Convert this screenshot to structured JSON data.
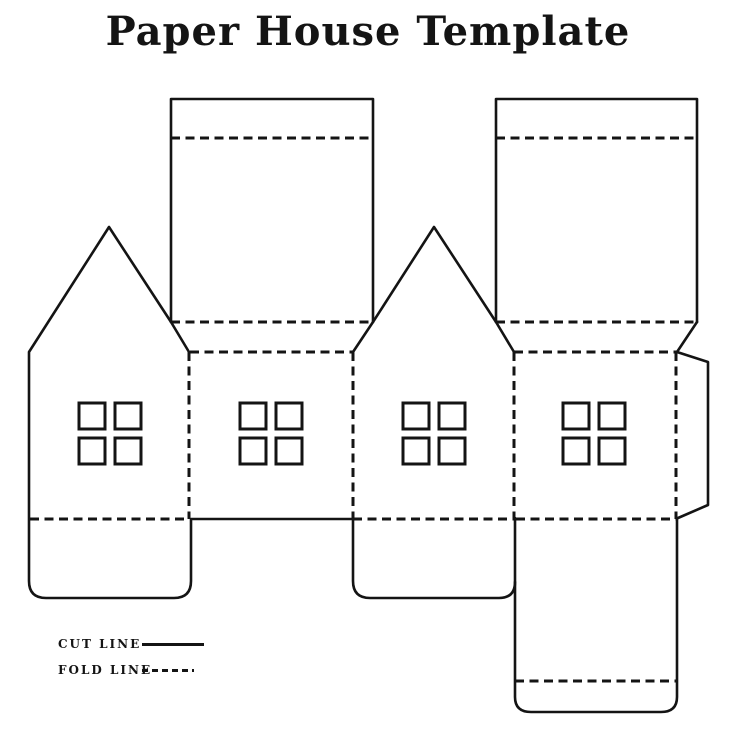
{
  "title": "Paper House Template",
  "legend": {
    "items": [
      {
        "label": "CUT LINE",
        "style": "solid"
      },
      {
        "label": "FOLD LINE",
        "style": "dashed"
      }
    ]
  },
  "colors": {
    "line": "#141414",
    "background": "#ffffff",
    "text": "#141414"
  },
  "diagram": {
    "description": "Unfolded cut-and-fold paper house template",
    "panels": [
      "gable-end-left",
      "side-wall-1",
      "gable-end-right",
      "side-wall-2"
    ],
    "roof_panels": 2,
    "bottom_flaps": 2,
    "base_panel_with_tuck_flap": 1,
    "glue_tab": 1,
    "window_panes_per_panel": 4
  }
}
